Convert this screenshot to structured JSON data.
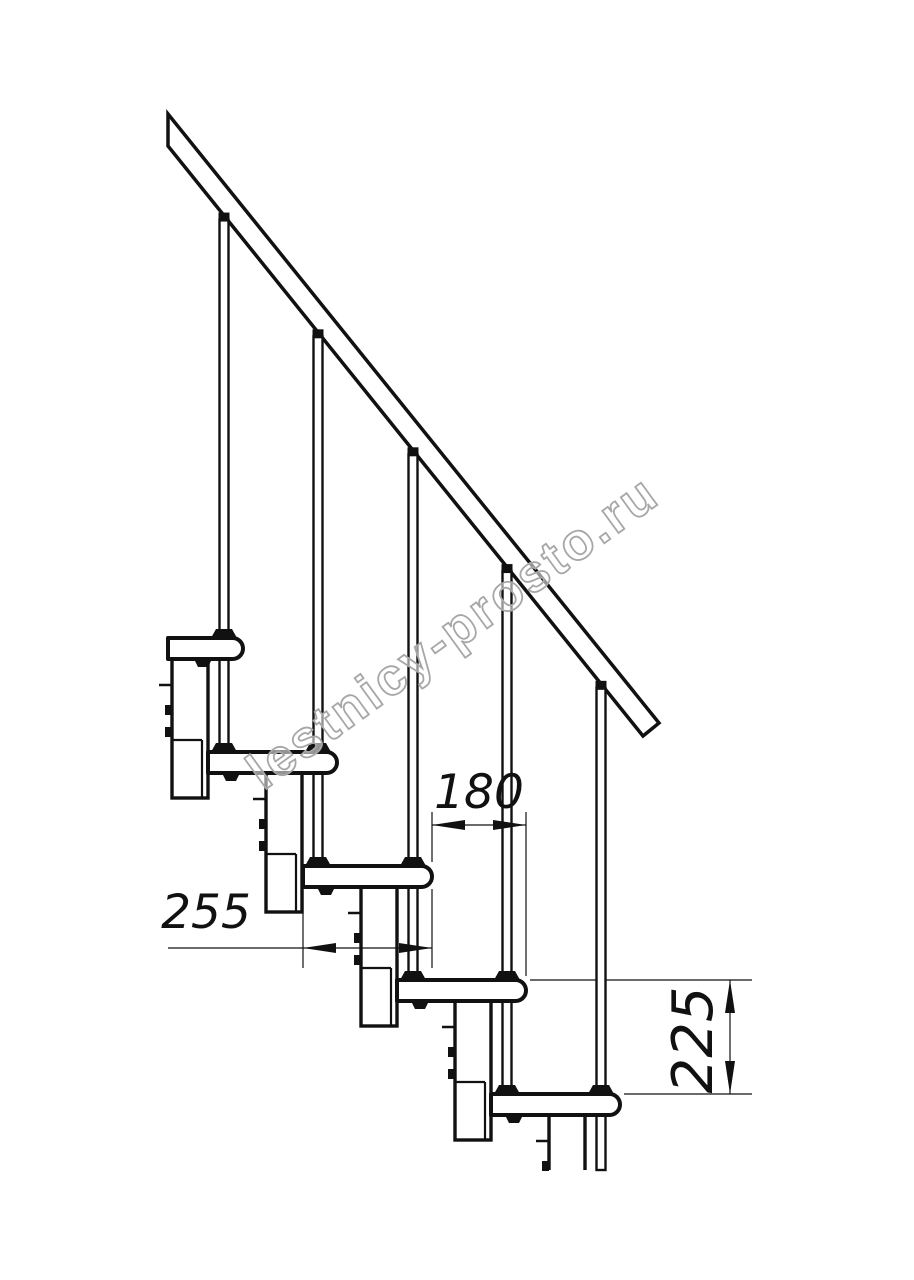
{
  "meta": {
    "description": "Side elevation technical drawing of a modular (kit) staircase section: five treads on stacked support modules, balusters passing through tread nosings to the tread below, and an inclined handrail. Dimensioned in millimetres.",
    "units": "mm",
    "line_color": "#111111",
    "background_color": "#ffffff"
  },
  "watermark": {
    "text": "lestnicy-prosto.ru",
    "color": "#a7a7a7",
    "angle_deg": -36,
    "center": [
      463,
      646
    ],
    "font_size": 52
  },
  "chart_data": {
    "type": "table",
    "title": "Staircase step dimensions",
    "categories": [
      "tread depth",
      "step run between nosings",
      "riser height"
    ],
    "values": [
      255,
      180,
      225
    ],
    "units": "mm"
  },
  "drawing": {
    "canvas": {
      "w": 914,
      "h": 1280
    },
    "stair": {
      "step_count": 5,
      "noses": [
        243,
        337,
        432,
        526,
        620
      ],
      "tops": [
        638,
        752,
        866,
        980,
        1094
      ],
      "tread_w": 129,
      "tread_h": 21,
      "nose_r": 10.5,
      "tread0_left_clip": 168,
      "baluster_offset": 19,
      "baluster_w": 9,
      "rail_poly": [
        [
          168,
          114
        ],
        [
          168,
          146
        ],
        [
          643,
          736
        ],
        [
          659,
          723
        ]
      ],
      "rail_low_start": [
        168,
        146
      ],
      "rail_slope": 1.2421,
      "module": {
        "off_left": 71,
        "width": 36,
        "top_gap": 21,
        "drop": 160,
        "joint_up": 58,
        "joint_in": 30,
        "stub_dy": 26,
        "tab_dy1": 46,
        "tab_dy2": 68
      },
      "cut_y": 1170
    },
    "dims": [
      {
        "label": "180",
        "type": "h",
        "y": 825,
        "tip1": 432,
        "tip2": 526,
        "line": [
          432,
          526
        ],
        "ext": [
          [
            432,
            812,
            862
          ],
          [
            432,
            889,
            968
          ],
          [
            526,
            812,
            976
          ]
        ],
        "text": {
          "x": 479,
          "y": 808,
          "size": 47,
          "rotate": 0
        }
      },
      {
        "label": "255",
        "type": "h",
        "y": 948,
        "tip1": 303,
        "tip2": 432,
        "line": [
          168,
          432
        ],
        "ext": [
          [
            303,
            890,
            968
          ]
        ],
        "text": {
          "x": 206,
          "y": 928,
          "size": 47,
          "rotate": 0
        }
      },
      {
        "label": "225",
        "type": "v",
        "x": 730,
        "tip1": 980,
        "tip2": 1094,
        "line": [
          980,
          1094
        ],
        "ext": [
          [
            980,
            530,
            752
          ],
          [
            1094,
            624,
            752
          ]
        ],
        "text": {
          "x": 712,
          "y": 1040,
          "size": 56,
          "rotate": -90
        }
      }
    ]
  }
}
